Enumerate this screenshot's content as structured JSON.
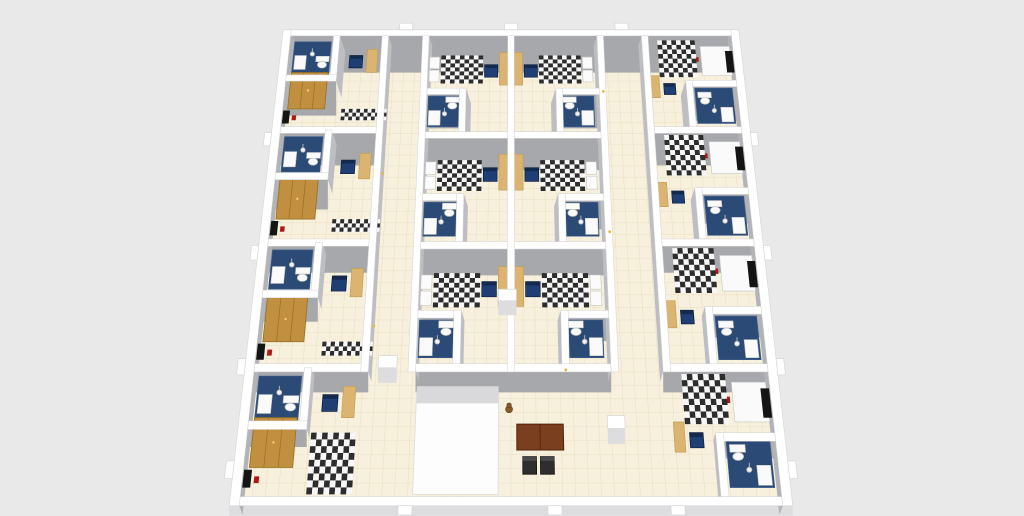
{
  "scene": {
    "kind": "3d-floorplan-dollhouse-render",
    "subject": "dormitory floor with studio rooms, two corridors and entrance lobby"
  },
  "canvas": {
    "width": 1024,
    "height": 516,
    "background": "#e9e9e9"
  },
  "projection": {
    "center_x": 511,
    "vanish_y": -1981,
    "k": 2489,
    "c": 0.2387,
    "depth": 520
  },
  "colors": {
    "background": "#e9e9e9",
    "floor": "#f7f0dc",
    "grid": "#e8dec2",
    "wall_cap": "#ffffff",
    "wall_edge": "#d2d2d4",
    "face_south": "#a7a8ac",
    "face_side": "#bdbec2",
    "face_ext": "#b2b3b7",
    "face_light": "#dddddf",
    "bath_floor": "#2b4a75",
    "bath_grid": "#3c5e91",
    "bed_dark": "#2d2d2d",
    "bed_light": "#f7f7f7",
    "pillow": "#fbfbfb",
    "desk": "#dab470",
    "desk_edge": "#bf9b52",
    "wardrobe": "#c08f3f",
    "wardrobe_edge": "#97701f",
    "chair": "#1e3e74",
    "chair_dark": "#13294e",
    "tv": "#141414",
    "red": "#b01818",
    "white": "#fafafa",
    "fixture_edge": "#c5c5c5",
    "table_top": "#7a3f1e",
    "table_edge": "#541f08",
    "lobby_chair": "#2e2e2e",
    "teddy": "#8a5a2b",
    "teddy_edge": "#6b4320",
    "lamp": "#f2f2f2",
    "lamp_edge": "#b5b5b5",
    "switch": "#e2b93b",
    "vestibule": "#fdfdfd",
    "vestibule_shadow": "#d9d9db"
  },
  "floor_slab": {
    "u0": -276,
    "v0": 4,
    "u1": 276,
    "v1": 516,
    "tile": 13
  },
  "walls": [
    {
      "name": "exterior-wall-north",
      "u0": -282,
      "v0": 510,
      "u1": 282,
      "v1": 518,
      "band": "s",
      "ext": true
    },
    {
      "name": "exterior-wall-south",
      "u0": -282,
      "v0": 2,
      "u1": 282,
      "v1": 10,
      "band": "s",
      "ext": true,
      "bh": 10
    },
    {
      "name": "exterior-wall-west",
      "u0": -282,
      "v0": 2,
      "u1": -272,
      "v1": 518,
      "band": "e",
      "ext": true
    },
    {
      "name": "exterior-wall-east",
      "u0": 272,
      "v0": 2,
      "u1": 282,
      "v1": 518,
      "band": "w",
      "ext": true
    },
    {
      "name": "interior-wall",
      "u0": -272,
      "v0": 126,
      "u1": -151,
      "v1": 134,
      "band": "s"
    },
    {
      "name": "interior-wall",
      "u0": -272,
      "v0": 256,
      "u1": -151,
      "v1": 264,
      "band": "s"
    },
    {
      "name": "interior-wall",
      "u0": -272,
      "v0": 386,
      "u1": -151,
      "v1": 394,
      "band": "s"
    },
    {
      "name": "interior-wall",
      "u0": 161,
      "v0": 126,
      "u1": 272,
      "v1": 134,
      "band": "s"
    },
    {
      "name": "interior-wall",
      "u0": 161,
      "v0": 256,
      "u1": 272,
      "v1": 264,
      "band": "s"
    },
    {
      "name": "interior-wall",
      "u0": 161,
      "v0": 386,
      "u1": 272,
      "v1": 394,
      "band": "s"
    },
    {
      "name": "interior-wall",
      "u0": -101,
      "v0": 126,
      "u1": 106,
      "v1": 134,
      "band": "s"
    },
    {
      "name": "interior-wall",
      "u0": -101,
      "v0": 253,
      "u1": 106,
      "v1": 261,
      "band": "s"
    },
    {
      "name": "interior-wall",
      "u0": -101,
      "v0": 380,
      "u1": 106,
      "v1": 388,
      "band": "s"
    },
    {
      "name": "corridor-wall",
      "u0": -159,
      "v0": 126,
      "u1": -151,
      "v1": 510,
      "band": "e"
    },
    {
      "name": "corridor-wall",
      "u0": -109,
      "v0": 126,
      "u1": -101,
      "v1": 510,
      "band": "e"
    },
    {
      "name": "corridor-wall",
      "u0": 106,
      "v0": 126,
      "u1": 114,
      "v1": 510,
      "band": "w"
    },
    {
      "name": "corridor-wall",
      "u0": 161,
      "v0": 126,
      "u1": 169,
      "v1": 510,
      "band": "w"
    },
    {
      "name": "interior-wall",
      "u0": -4,
      "v0": 126,
      "u1": 4,
      "v1": 510,
      "band": "none"
    },
    {
      "name": "bath-wall",
      "u0": -219,
      "v0": 451,
      "u1": -211,
      "v1": 510,
      "band": "e"
    },
    {
      "name": "bath-wall",
      "u0": -219,
      "v0": 331,
      "u1": -211,
      "v1": 390,
      "band": "e"
    },
    {
      "name": "bath-wall",
      "u0": -219,
      "v0": 201,
      "u1": -211,
      "v1": 260,
      "band": "e"
    },
    {
      "name": "bath-wall",
      "u0": -219,
      "v0": 71,
      "u1": -211,
      "v1": 130,
      "band": "e"
    },
    {
      "name": "bath-wall",
      "u0": -272,
      "v0": 451,
      "u1": -211,
      "v1": 459,
      "band": "s"
    },
    {
      "name": "bath-wall",
      "u0": -272,
      "v0": 331,
      "u1": -211,
      "v1": 339,
      "band": "s"
    },
    {
      "name": "bath-wall",
      "u0": -272,
      "v0": 201,
      "u1": -211,
      "v1": 209,
      "band": "s"
    },
    {
      "name": "bath-wall",
      "u0": -272,
      "v0": 71,
      "u1": -211,
      "v1": 79,
      "band": "s"
    },
    {
      "name": "bath-wall",
      "u0": 211,
      "v0": 394,
      "u1": 219,
      "v1": 452,
      "band": "w"
    },
    {
      "name": "bath-wall",
      "u0": 211,
      "v0": 264,
      "u1": 219,
      "v1": 322,
      "band": "w"
    },
    {
      "name": "bath-wall",
      "u0": 211,
      "v0": 134,
      "u1": 219,
      "v1": 192,
      "band": "w"
    },
    {
      "name": "bath-wall",
      "u0": 211,
      "v0": 10,
      "u1": 219,
      "v1": 68,
      "band": "w"
    },
    {
      "name": "bath-wall",
      "u0": 211,
      "v0": 444,
      "u1": 272,
      "v1": 452,
      "band": "s"
    },
    {
      "name": "bath-wall",
      "u0": 211,
      "v0": 314,
      "u1": 272,
      "v1": 322,
      "band": "s"
    },
    {
      "name": "bath-wall",
      "u0": 211,
      "v0": 184,
      "u1": 272,
      "v1": 192,
      "band": "s"
    },
    {
      "name": "bath-wall",
      "u0": 211,
      "v0": 60,
      "u1": 272,
      "v1": 68,
      "band": "s"
    },
    {
      "name": "bath-wall",
      "u0": -62,
      "v0": 388,
      "u1": -54,
      "v1": 442,
      "band": "e"
    },
    {
      "name": "bath-wall",
      "u0": -62,
      "v0": 261,
      "u1": -54,
      "v1": 315,
      "band": "e"
    },
    {
      "name": "bath-wall",
      "u0": -62,
      "v0": 134,
      "u1": -54,
      "v1": 188,
      "band": "e"
    },
    {
      "name": "bath-wall",
      "u0": -101,
      "v0": 434,
      "u1": -54,
      "v1": 442,
      "band": "s"
    },
    {
      "name": "bath-wall",
      "u0": -101,
      "v0": 307,
      "u1": -54,
      "v1": 315,
      "band": "s"
    },
    {
      "name": "bath-wall",
      "u0": -101,
      "v0": 180,
      "u1": -54,
      "v1": 188,
      "band": "s"
    },
    {
      "name": "bath-wall",
      "u0": 54,
      "v0": 388,
      "u1": 62,
      "v1": 442,
      "band": "w"
    },
    {
      "name": "bath-wall",
      "u0": 54,
      "v0": 261,
      "u1": 62,
      "v1": 315,
      "band": "w"
    },
    {
      "name": "bath-wall",
      "u0": 54,
      "v0": 134,
      "u1": 62,
      "v1": 188,
      "band": "w"
    },
    {
      "name": "bath-wall",
      "u0": 54,
      "v0": 434,
      "u1": 106,
      "v1": 442,
      "band": "s"
    },
    {
      "name": "bath-wall",
      "u0": 54,
      "v0": 307,
      "u1": 106,
      "v1": 315,
      "band": "s"
    },
    {
      "name": "bath-wall",
      "u0": 54,
      "v0": 180,
      "u1": 106,
      "v1": 188,
      "band": "s"
    }
  ],
  "blocks": [
    {
      "name": "door-block",
      "u0": -141,
      "v0": 130,
      "u1": -121,
      "v1": 142
    },
    {
      "name": "door-block",
      "u0": 100,
      "v0": 72,
      "u1": 118,
      "v1": 84
    },
    {
      "name": "door-block",
      "u0": -14,
      "v0": 198,
      "u1": 6,
      "v1": 210
    }
  ],
  "windows": {
    "top": [
      -130,
      0,
      137
    ],
    "left": [
      34,
      131,
      249,
      379
    ],
    "right": [
      34,
      131,
      249,
      379
    ],
    "bottom": [
      -106,
      44,
      167
    ]
  },
  "rooms": [
    {
      "id": "room-left-4",
      "type": "side_left",
      "v0": 390,
      "v1": 510,
      "bed": false
    },
    {
      "id": "room-right-4",
      "type": "side_right",
      "v0": 390,
      "v1": 510
    },
    {
      "id": "room-mid-3w",
      "type": "mid_west",
      "v0": 388,
      "v1": 510
    },
    {
      "id": "room-mid-3e",
      "type": "mid_east",
      "v0": 388,
      "v1": 510
    },
    {
      "id": "room-left-3",
      "type": "side_left",
      "v0": 260,
      "v1": 390,
      "bed": false
    },
    {
      "id": "room-right-3",
      "type": "side_right",
      "v0": 260,
      "v1": 390
    },
    {
      "id": "room-mid-2w",
      "type": "mid_west",
      "v0": 261,
      "v1": 380
    },
    {
      "id": "room-mid-2e",
      "type": "mid_east",
      "v0": 261,
      "v1": 380
    },
    {
      "id": "room-left-2",
      "type": "side_left",
      "v0": 130,
      "v1": 260,
      "bed": false
    },
    {
      "id": "room-right-2",
      "type": "side_right",
      "v0": 130,
      "v1": 260
    },
    {
      "id": "room-mid-1w",
      "type": "mid_west",
      "v0": 134,
      "v1": 253
    },
    {
      "id": "room-mid-1e",
      "type": "mid_east",
      "v0": 134,
      "v1": 253
    },
    {
      "id": "room-left-1",
      "type": "side_left",
      "v0": 10,
      "v1": 130,
      "bed": true
    },
    {
      "id": "room-right-1",
      "type": "side_right",
      "v0": 10,
      "v1": 130
    }
  ],
  "templates": {
    "side_left": [
      {
        "kind": "rect",
        "name": "bathroom-floor",
        "u0": -266,
        "u1": -221,
        "a": "v1",
        "d0": -50,
        "d1": -8,
        "color": "bath_floor",
        "stroke": "bath_grid"
      },
      {
        "kind": "rect",
        "name": "shower-tray",
        "u0": -264,
        "u1": -250,
        "a": "v1",
        "d0": -44,
        "d1": -26,
        "color": "white",
        "stroke": "fixture_edge"
      },
      {
        "kind": "toilet",
        "name": "toilet",
        "u": -230,
        "a": "v1",
        "dc": -38
      },
      {
        "kind": "lamp",
        "name": "ceiling-lamp",
        "u": -243,
        "a": "v1",
        "dc": -24
      },
      {
        "kind": "wardrobe",
        "name": "wardrobe",
        "u0": -266,
        "u1": -222,
        "a": "v0",
        "d0": 26,
        "d1": 72
      },
      {
        "kind": "rect",
        "name": "tv-panel",
        "u0": -271,
        "u1": -263,
        "a": "v0",
        "d0": 8,
        "d1": 24,
        "color": "tv"
      },
      {
        "kind": "rect",
        "name": "fire-extinguisher",
        "u0": -260,
        "u1": -255,
        "a": "v0",
        "d0": 12,
        "d1": 18,
        "color": "red"
      },
      {
        "kind": "checker",
        "name": "rug",
        "u0": -202,
        "u1": -148,
        "a": "v0",
        "d0": 12,
        "d1": 26,
        "cell": 4.5,
        "when": "nobed"
      },
      {
        "kind": "checker",
        "name": "bed",
        "u0": -206,
        "u1": -160,
        "a": "v0",
        "d0": 2,
        "d1": 58,
        "cell": 6,
        "when": "bed"
      },
      {
        "kind": "rect",
        "name": "desk",
        "u0": -176,
        "u1": -163,
        "a": "v0",
        "d0": 72,
        "d1": 102,
        "color": "desk",
        "stroke": "desk_edge"
      },
      {
        "kind": "chair",
        "name": "desk-chair",
        "u0": -197,
        "u1": -181,
        "a": "v0",
        "d0": 78,
        "d1": 94
      }
    ],
    "side_right": [
      {
        "kind": "rect",
        "name": "bathroom-floor",
        "u0": 221,
        "u1": 266,
        "a": "v0",
        "d0": 8,
        "d1": 52,
        "color": "bath_floor",
        "stroke": "bath_grid"
      },
      {
        "kind": "rect",
        "name": "shower-tray",
        "u0": 250,
        "u1": 264,
        "a": "v0",
        "d0": 10,
        "d1": 28,
        "color": "white",
        "stroke": "fixture_edge"
      },
      {
        "kind": "toilet",
        "name": "toilet",
        "u": 232,
        "a": "v0",
        "dc": 36
      },
      {
        "kind": "lamp",
        "name": "ceiling-lamp",
        "u": 242,
        "a": "v0",
        "dc": 24
      },
      {
        "kind": "rect",
        "name": "shelf-unit",
        "u0": 232,
        "u1": 268,
        "a": "v1",
        "d0": -52,
        "d1": -14,
        "color": "white",
        "stroke": "fixture_edge"
      },
      {
        "kind": "rect",
        "name": "tv-panel",
        "u0": 262,
        "u1": 271,
        "a": "v1",
        "d0": -48,
        "d1": -20,
        "color": "tv"
      },
      {
        "kind": "rect",
        "name": "fire-extinguisher",
        "u0": 224,
        "u1": 229,
        "a": "v1",
        "d0": -34,
        "d1": -28,
        "color": "red"
      },
      {
        "kind": "checker",
        "name": "bed",
        "u0": 180,
        "u1": 226,
        "a": "v1",
        "d0": -54,
        "d1": -6,
        "cell": 6
      },
      {
        "kind": "rect",
        "name": "desk",
        "u0": 168,
        "u1": 179,
        "a": "v0",
        "d0": 40,
        "d1": 68,
        "color": "desk",
        "stroke": "desk_edge"
      },
      {
        "kind": "chair",
        "name": "desk-chair",
        "u0": 184,
        "u1": 198,
        "a": "v0",
        "d0": 44,
        "d1": 58
      }
    ],
    "mid_west": [
      {
        "kind": "rect",
        "name": "bathroom-floor",
        "u0": -99,
        "u1": -60,
        "a": "v0",
        "d0": 6,
        "d1": 44,
        "color": "bath_floor",
        "stroke": "bath_grid"
      },
      {
        "kind": "rect",
        "name": "shower-tray",
        "u0": -98,
        "u1": -84,
        "a": "v0",
        "d0": 8,
        "d1": 26,
        "color": "white",
        "stroke": "fixture_edge"
      },
      {
        "kind": "toilet",
        "name": "toilet",
        "u": -70,
        "a": "v0",
        "dc": 32
      },
      {
        "kind": "lamp",
        "name": "ceiling-lamp",
        "u": -79,
        "a": "v0",
        "dc": 22
      },
      {
        "kind": "checker",
        "name": "bed",
        "u0": -85,
        "u1": -34,
        "a": "v1",
        "d0": -62,
        "d1": -26,
        "cell": 5.5
      },
      {
        "kind": "rect",
        "name": "pillow",
        "u0": -99,
        "u1": -87,
        "a": "v1",
        "d0": -60,
        "d1": -45,
        "color": "pillow",
        "stroke": "fixture_edge"
      },
      {
        "kind": "rect",
        "name": "pillow",
        "u0": -99,
        "u1": -87,
        "a": "v1",
        "d0": -43,
        "d1": -28,
        "color": "pillow",
        "stroke": "fixture_edge"
      },
      {
        "kind": "rect",
        "name": "desk",
        "u0": -14,
        "u1": -2,
        "a": "v0",
        "d0": 58,
        "d1": 100,
        "color": "desk",
        "stroke": "desk_edge"
      },
      {
        "kind": "chair",
        "name": "desk-chair",
        "u0": -32,
        "u1": -16,
        "a": "v0",
        "d0": 68,
        "d1": 84
      }
    ],
    "mid_east": [
      {
        "kind": "rect",
        "name": "bathroom-floor",
        "u0": 60,
        "u1": 99,
        "a": "v0",
        "d0": 6,
        "d1": 44,
        "color": "bath_floor",
        "stroke": "bath_grid"
      },
      {
        "kind": "rect",
        "name": "shower-tray",
        "u0": 84,
        "u1": 98,
        "a": "v0",
        "d0": 8,
        "d1": 26,
        "color": "white",
        "stroke": "fixture_edge"
      },
      {
        "kind": "toilet",
        "name": "toilet",
        "u": 70,
        "a": "v0",
        "dc": 32
      },
      {
        "kind": "lamp",
        "name": "ceiling-lamp",
        "u": 79,
        "a": "v0",
        "dc": 22
      },
      {
        "kind": "checker",
        "name": "bed",
        "u0": 34,
        "u1": 85,
        "a": "v1",
        "d0": -62,
        "d1": -26,
        "cell": 5.5
      },
      {
        "kind": "rect",
        "name": "pillow",
        "u0": 87,
        "u1": 99,
        "a": "v1",
        "d0": -60,
        "d1": -45,
        "color": "pillow",
        "stroke": "fixture_edge"
      },
      {
        "kind": "rect",
        "name": "pillow",
        "u0": 87,
        "u1": 99,
        "a": "v1",
        "d0": -43,
        "d1": -28,
        "color": "pillow",
        "stroke": "fixture_edge"
      },
      {
        "kind": "rect",
        "name": "desk",
        "u0": 2,
        "u1": 14,
        "a": "v0",
        "d0": 58,
        "d1": 100,
        "color": "desk",
        "stroke": "desk_edge"
      },
      {
        "kind": "chair",
        "name": "desk-chair",
        "u0": 16,
        "u1": 32,
        "a": "v0",
        "d0": 68,
        "d1": 84
      }
    ]
  },
  "lobby": {
    "vestibule_shadow": {
      "u0": -99,
      "v0": 96,
      "u1": -13,
      "v1": 112
    },
    "vestibule": {
      "u0": -99,
      "v0": 12,
      "u1": -13,
      "v1": 96
    },
    "table": {
      "u0": 6,
      "v0": 52,
      "u1": 54,
      "v1": 76
    },
    "chairs": [
      {
        "u0": 12,
        "v0": 30,
        "u1": 26,
        "v1": 46
      },
      {
        "u0": 30,
        "v0": 30,
        "u1": 44,
        "v1": 46
      }
    ],
    "figure": {
      "u": -2,
      "v": 90
    }
  },
  "switches": [
    {
      "u": -148,
      "v": 338
    },
    {
      "u": -148,
      "v": 172
    },
    {
      "u": 111,
      "v": 272
    },
    {
      "u": 111,
      "v": 438
    },
    {
      "u": 58,
      "v": 128
    }
  ]
}
